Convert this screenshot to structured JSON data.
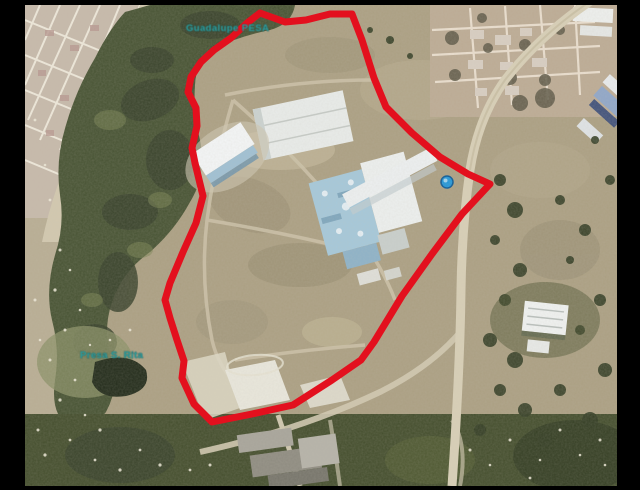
{
  "window": {
    "width": 640,
    "height": 490,
    "letterbox_color": "#000000"
  },
  "map": {
    "kind": "satellite-aerial-photo",
    "description": "Aerial photograph of a large parcel outlined in red, bordered by an urban grid to the northwest, a dark vegetation corridor along the west, a highway to the east and industrial buildings inside the boundary",
    "boundary": {
      "color": "#e3101e",
      "stroke_width": 7,
      "points": [
        [
          260,
          13
        ],
        [
          285,
          22
        ],
        [
          306,
          20
        ],
        [
          330,
          14
        ],
        [
          352,
          14
        ],
        [
          362,
          40
        ],
        [
          374,
          78
        ],
        [
          386,
          107
        ],
        [
          412,
          133
        ],
        [
          440,
          157
        ],
        [
          468,
          174
        ],
        [
          490,
          184
        ],
        [
          462,
          214
        ],
        [
          432,
          254
        ],
        [
          402,
          296
        ],
        [
          374,
          342
        ],
        [
          361,
          360
        ],
        [
          332,
          380
        ],
        [
          293,
          405
        ],
        [
          252,
          414
        ],
        [
          212,
          422
        ],
        [
          194,
          404
        ],
        [
          182,
          378
        ],
        [
          184,
          361
        ],
        [
          177,
          340
        ],
        [
          170,
          318
        ],
        [
          165,
          300
        ],
        [
          170,
          283
        ],
        [
          183,
          252
        ],
        [
          196,
          223
        ],
        [
          203,
          196
        ],
        [
          195,
          163
        ],
        [
          192,
          148
        ],
        [
          197,
          126
        ],
        [
          196,
          108
        ],
        [
          188,
          92
        ],
        [
          191,
          77
        ],
        [
          201,
          62
        ],
        [
          214,
          50
        ],
        [
          231,
          38
        ],
        [
          247,
          23
        ],
        [
          260,
          13
        ]
      ]
    },
    "labels": {
      "top": {
        "text": "Guadalupe PESA",
        "color": "#2f9e9e"
      },
      "bottom": {
        "text": "Presa S. Rita",
        "color": "#2f9e9e"
      }
    },
    "features": [
      "urban-grid-northwest",
      "vegetation-corridor-west",
      "site-boundary-red",
      "industrial-complex-blue-roofs",
      "white-warehouse-slab",
      "water-tank-blue-dot",
      "highway-east",
      "urban-grid-northeast",
      "warehouses-east",
      "scrub-and-roads-south"
    ]
  }
}
